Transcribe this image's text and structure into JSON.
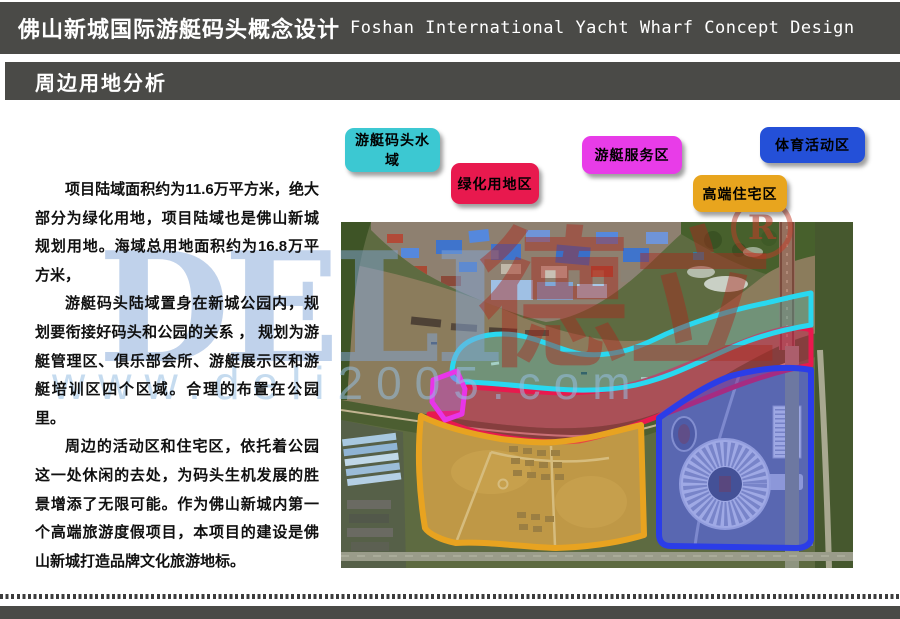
{
  "header": {
    "title_zh": "佛山新城国际游艇码头概念设计",
    "title_en": "Foshan International Yacht Wharf Concept Design",
    "section": "周边用地分析"
  },
  "body": {
    "p1": "项目陆域面积约为11.6万平方米，绝大部分为绿化用地，项目陆域也是佛山新城规划用地。海域总用地面积约为16.8万平方米，",
    "p2": "游艇码头陆域置身在新城公园内，规划要衔接好码头和公园的关系 ， 规划为游艇管理区、俱乐部会所、游艇展示区和游艇培训区四个区域。合理的布置在公园里。",
    "p3": "周边的活动区和住宅区，依托着公园这一处休闲的去处，为码头生机发展的胜景增添了无限可能。作为佛山新城内第一个高端旅游度假项目，本项目的建设是佛山新城打造品牌文化旅游地标。"
  },
  "legend": {
    "items": [
      {
        "label": "游艇码头水域",
        "color": "#3cc8d2"
      },
      {
        "label": "绿化用地区",
        "color": "#e8194e"
      },
      {
        "label": "游艇服务区",
        "color": "#e83ce8"
      },
      {
        "label": "高端住宅区",
        "color": "#e8a51e"
      },
      {
        "label": "体育活动区",
        "color": "#2450d8"
      }
    ]
  },
  "map": {
    "region_colors": {
      "water": "#29d8f0",
      "green": "#e8194e",
      "service": "#e835e8",
      "residential": "#e8a320",
      "sports": "#2b3de8"
    }
  },
  "watermark": {
    "letters": "DELI",
    "chars": "德立",
    "registered": "R",
    "url": "www.deli2005.com"
  }
}
